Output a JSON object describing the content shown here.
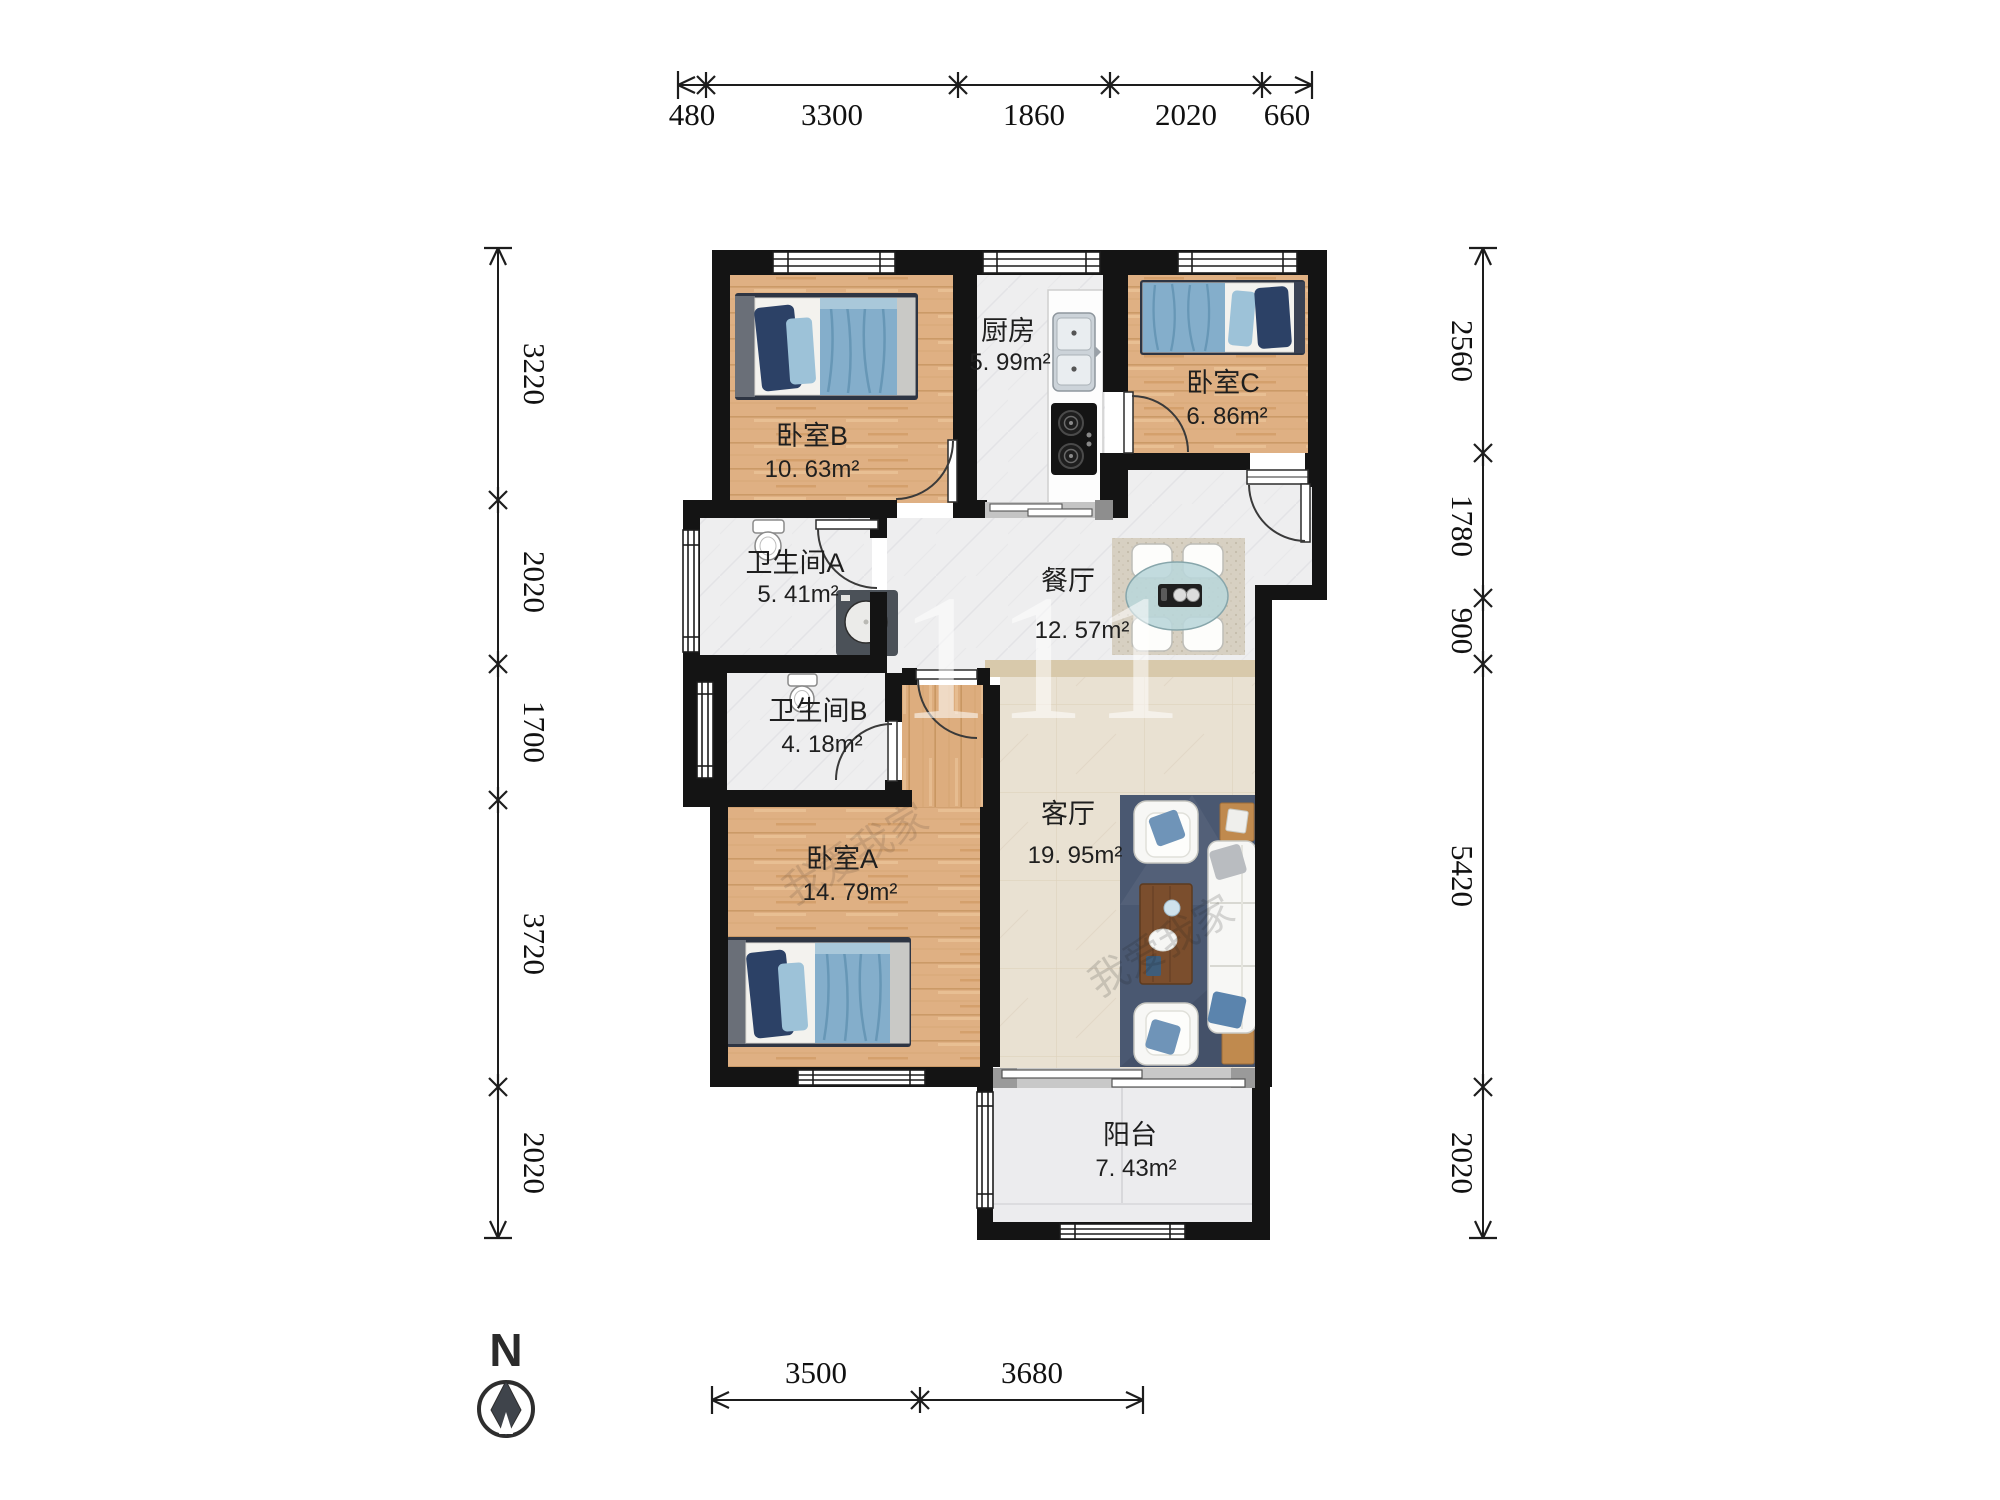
{
  "title": "户型图",
  "rooms": [
    {
      "id": "bedroom-b",
      "name": "卧室B",
      "area": "10. 63m²"
    },
    {
      "id": "kitchen",
      "name": "厨房",
      "area": "5. 99m²"
    },
    {
      "id": "bedroom-c",
      "name": "卧室C",
      "area": "6. 86m²"
    },
    {
      "id": "bathroom-a",
      "name": "卫生间A",
      "area": "5. 41m²"
    },
    {
      "id": "dining-room",
      "name": "餐厅",
      "area": "12. 57m²"
    },
    {
      "id": "bathroom-b",
      "name": "卫生间B",
      "area": "4. 18m²"
    },
    {
      "id": "bedroom-a",
      "name": "卧室A",
      "area": "14. 79m²"
    },
    {
      "id": "living-room",
      "name": "客厅",
      "area": "19. 95m²"
    },
    {
      "id": "balcony",
      "name": "阳台",
      "area": "7. 43m²"
    }
  ],
  "dimensions": {
    "top": [
      "480",
      "3300",
      "1860",
      "2020",
      "660"
    ],
    "left": [
      "3220",
      "2020",
      "1700",
      "3720",
      "2020"
    ],
    "right": [
      "2560",
      "1780",
      "900",
      "5420",
      "2020"
    ],
    "bottom": [
      "3500",
      "3680"
    ]
  },
  "compass": {
    "label": "N"
  },
  "watermark": {
    "center": "111",
    "brand": "我爱我家"
  },
  "colors": {
    "wall": "#141414",
    "wood": "#dfb083",
    "tile": "#eeeeef",
    "living_floor": "#e9e1d2",
    "rug_blue": "#4a5871",
    "blanket_blue": "#84aecb",
    "pillow_navy": "#2c4166",
    "glass_table": "#b9d6da"
  }
}
